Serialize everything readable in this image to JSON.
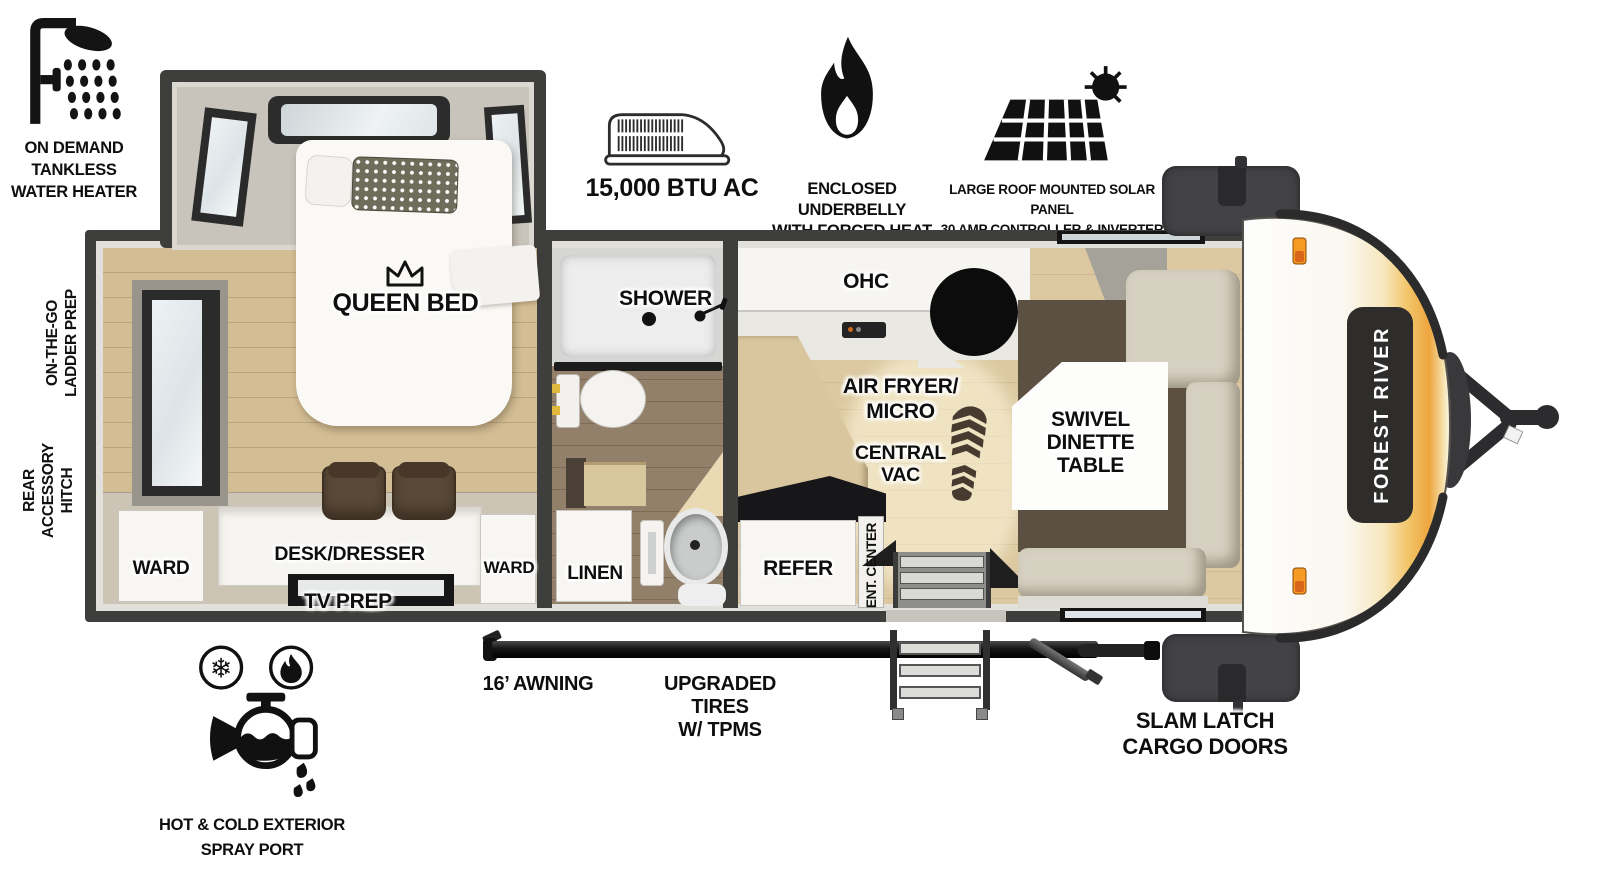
{
  "brand": "FOREST RIVER",
  "colors": {
    "wall": "#3e3e3c",
    "floor_wood": "#d3bd94",
    "accent_orange": "#f0a83c",
    "sofa": "#d7d1c2",
    "dinette_rug": "#5c5043",
    "logo_box": "#2e2d2c"
  },
  "callouts": {
    "water_heater": {
      "lines": [
        "ON DEMAND",
        "TANKLESS",
        "WATER HEATER"
      ]
    },
    "ac": {
      "label": "15,000 BTU AC"
    },
    "underbelly": {
      "lines": [
        "ENCLOSED UNDERBELLY",
        "WITH FORCED HEAT"
      ]
    },
    "solar": {
      "lines": [
        "LARGE ROOF MOUNTED SOLAR PANEL",
        "30 AMP CONTROLLER & INVERTER PREP"
      ]
    },
    "ladder_prep": {
      "lines": [
        "ON-THE-GO",
        "LADDER PREP"
      ]
    },
    "rear_hitch": {
      "lines": [
        "REAR",
        "ACCESSORY",
        "HITCH"
      ]
    },
    "awning": {
      "label": "16’ AWNING"
    },
    "tires": {
      "lines": [
        "UPGRADED TIRES",
        "W/ TPMS"
      ]
    },
    "cargo_doors": {
      "lines": [
        "SLAM LATCH",
        "CARGO DOORS"
      ]
    },
    "spray_port": {
      "lines": [
        "HOT & COLD EXTERIOR",
        "SPRAY PORT"
      ]
    }
  },
  "rooms": {
    "bedroom": {
      "bed": "QUEEN BED",
      "ward_left": "WARD",
      "ward_right": "WARD",
      "desk": "DESK/DRESSER",
      "tv": "TV PREP"
    },
    "bath": {
      "shower": "SHOWER",
      "linen": "LINEN"
    },
    "kitchen": {
      "ohc": "OHC",
      "air_fryer": {
        "lines": [
          "AIR FRYER/",
          "MICRO"
        ]
      },
      "central_vac": {
        "lines": [
          "CENTRAL",
          "VAC"
        ]
      },
      "refer": "REFER",
      "ent_center": "ENT. CENTER"
    },
    "living": {
      "dinette": {
        "lines": [
          "SWIVEL",
          "DINETTE",
          "TABLE"
        ]
      }
    }
  }
}
